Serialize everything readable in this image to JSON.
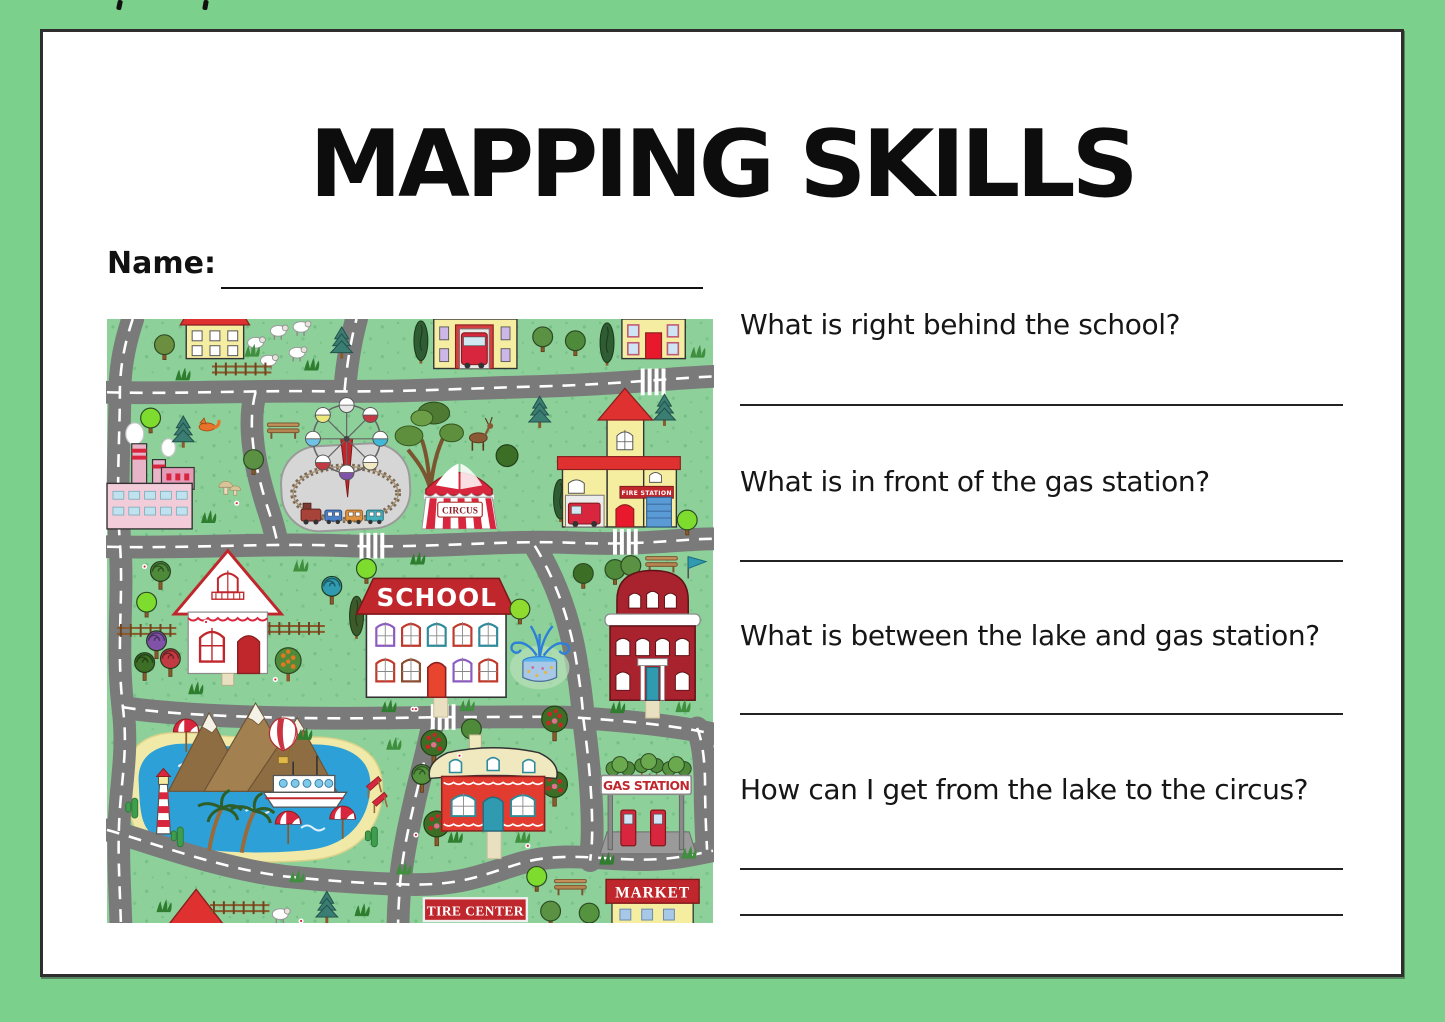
{
  "header": {
    "title": "MAPPING SKILLS"
  },
  "name_field": {
    "label": "Name:",
    "value": ""
  },
  "questions": [
    {
      "text": "What is right behind the school?",
      "answer_lines": 1
    },
    {
      "text": "What is in front of the gas station?",
      "answer_lines": 1
    },
    {
      "text": "What is between the lake and gas station?",
      "answer_lines": 1
    },
    {
      "text": "How can I get from the lake to the circus?",
      "answer_lines": 2
    }
  ],
  "map": {
    "labels": {
      "school": "SCHOOL",
      "circus": "CIRCUS",
      "fire_station": "FIRE STATION",
      "gas_station": "GAS STATION",
      "tire_center": "TIRE CENTER",
      "market": "MARKET"
    },
    "colors": {
      "border_green": "#7bd08c",
      "map_grass": "#8dd09a",
      "road_gray": "#7a7a7a",
      "lake_blue": "#2da0d8",
      "accent_red": "#c0272d"
    }
  }
}
